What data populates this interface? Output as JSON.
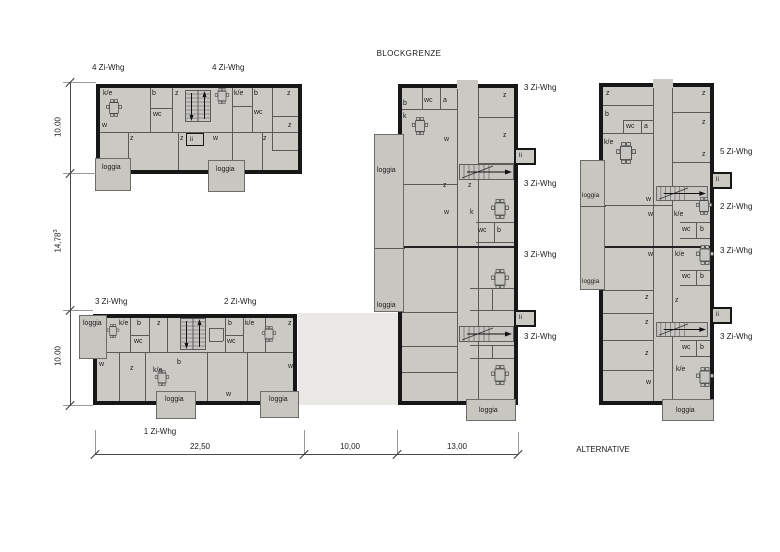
{
  "colors": {
    "plan_fill": "#cbc9c4",
    "loggia_fill": "#c8c6c1",
    "passage_fill": "#e9e8e5",
    "wall": "#171717",
    "line": "#5c5a56",
    "text": "#1c1c1c",
    "dim": "#4a4a4a"
  },
  "texts": {
    "blockgrenze": "BLOCKGRENZE",
    "alternative": "ALTERNATIVE"
  },
  "dims": {
    "left": [
      {
        "v": "10.00",
        "sup": ""
      },
      {
        "v": "14,78",
        "sup": "3"
      },
      {
        "v": "10.00",
        "sup": ""
      }
    ],
    "bottom": [
      "22,50",
      "10,00",
      "13,00"
    ]
  },
  "a": {
    "headers": [
      "4 Zi-Whg",
      "4 Zi-Whg"
    ],
    "rooms": {
      "ke_l": "k/e",
      "b_l": "b",
      "z_tl": "z",
      "wc_l": "wc",
      "w_l": "w",
      "z_b1": "z",
      "z_b2": "z",
      "li": "li",
      "w_b": "w",
      "z_b3": "z",
      "ke_r": "k/e",
      "b_r": "b",
      "z_tr": "z",
      "wc_r": "wc",
      "z_r": "z"
    },
    "loggias": [
      "loggia",
      "loggia"
    ]
  },
  "b": {
    "headers": [
      "3 Zi-Whg",
      "2 Zi-Whg"
    ],
    "footer": "1 Zi-Whg",
    "rooms": {
      "ke1": "k/e",
      "b1": "b",
      "z1": "z",
      "wc1": "wc",
      "b2": "b",
      "wc2": "wc",
      "ke2": "k/e",
      "z2": "z",
      "w1": "w",
      "z3": "z",
      "ke3": "k/e",
      "b3": "b",
      "w2": "w",
      "w3": "w"
    },
    "loggias": [
      "loggia",
      "loggia",
      "loggia"
    ]
  },
  "c": {
    "apt_labels": [
      "3 Zi-Whg",
      "3 Zi-Whg",
      "3 Zi-Whg",
      "3 Zi-Whg"
    ],
    "rooms": {
      "b1": "b",
      "wc1": "wc",
      "a1": "a",
      "k1": "k",
      "z1": "z",
      "z2": "z",
      "w1": "w",
      "z3": "z",
      "z4": "z",
      "w2": "w",
      "k2": "k",
      "wc2": "wc",
      "b2": "b"
    },
    "loggias": [
      "loggia",
      "loggia",
      "loggia"
    ],
    "lifts": [
      "li",
      "li"
    ]
  },
  "d": {
    "apt_labels": [
      "5 Zi-Whg",
      "2 Zi-Whg",
      "3 Zi-Whg",
      "3 Zi-Whg"
    ],
    "rooms": {
      "z1": "z",
      "b1": "b",
      "wc1": "wc",
      "a1": "a",
      "ke1": "k/e",
      "z2": "z",
      "z3": "z",
      "z4": "z",
      "w1": "w",
      "w2": "w",
      "ke2": "k/e",
      "wc2": "wc",
      "b2": "b",
      "w3": "w",
      "ke3": "k/e",
      "wc3": "wc",
      "b3": "b",
      "z5": "z",
      "z6": "z",
      "z7": "z",
      "z8": "z",
      "wc4": "wc",
      "b4": "b",
      "ke4": "k/e",
      "w4": "w"
    },
    "loggias": [
      "loggia",
      "loggia",
      "loggia"
    ],
    "lifts": [
      "li",
      "li"
    ]
  }
}
